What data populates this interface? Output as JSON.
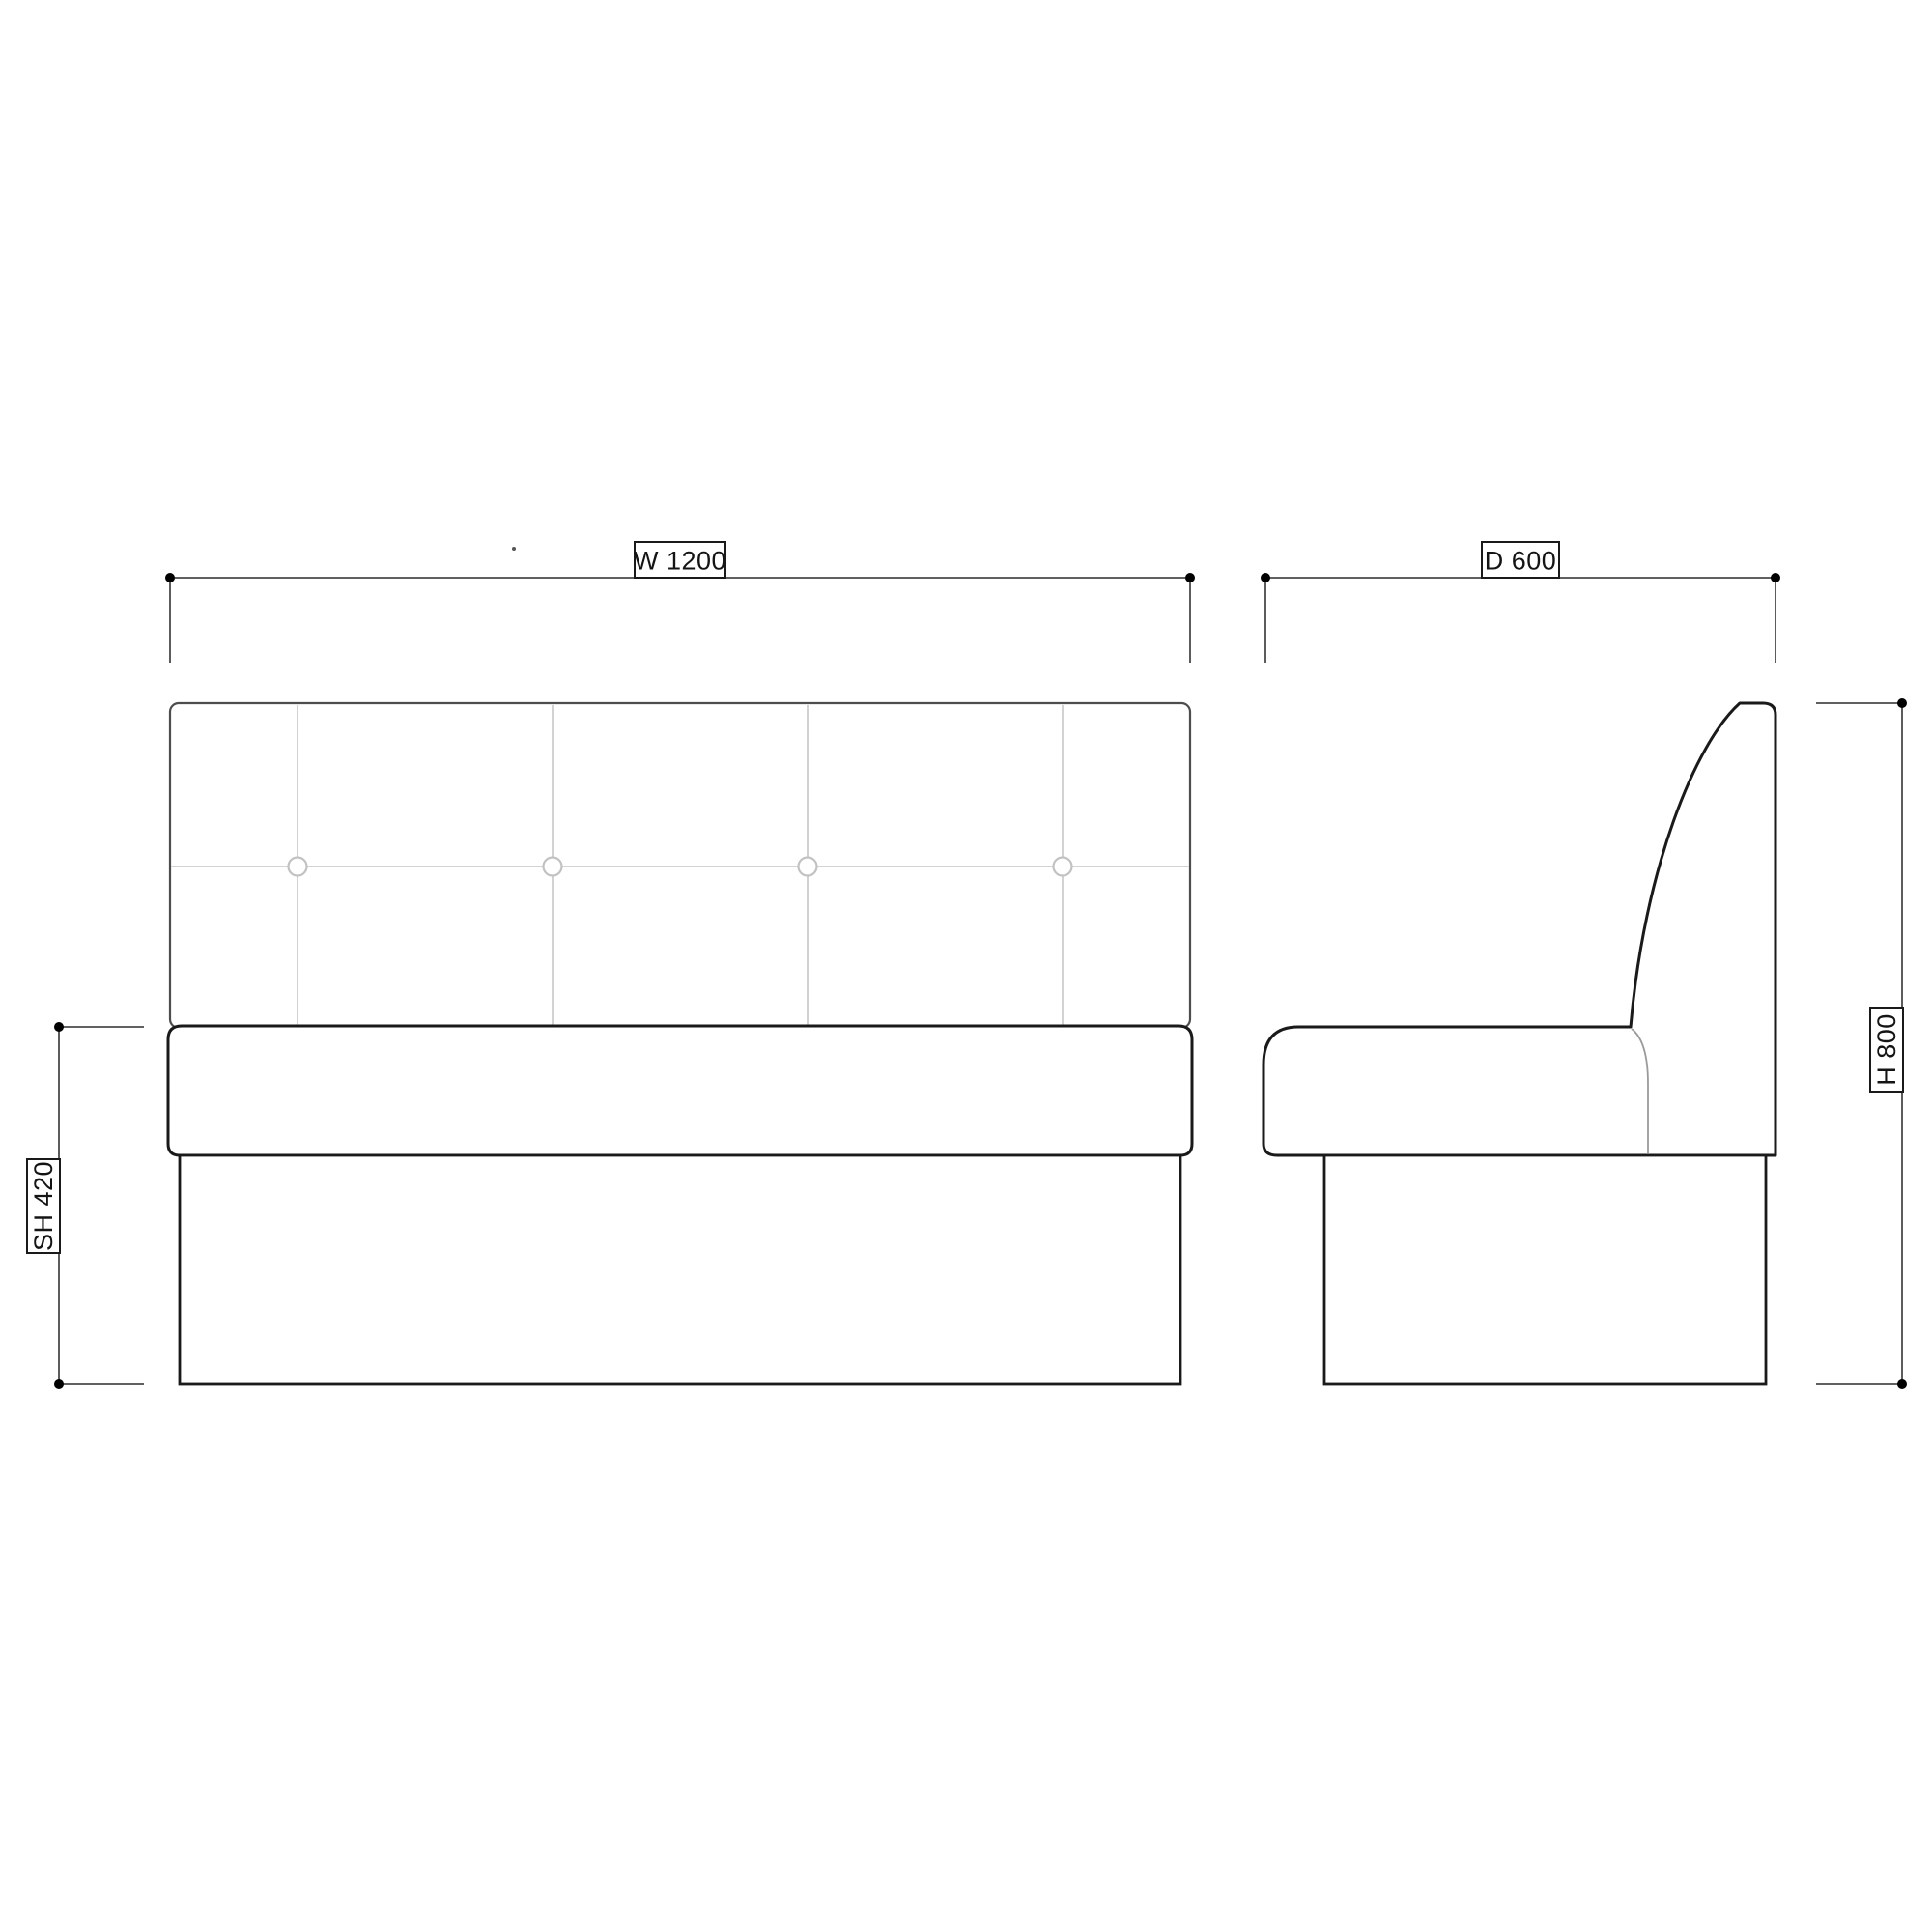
{
  "dimensions": {
    "width": {
      "label": "W 1200",
      "value": 1200,
      "axis": "horizontal"
    },
    "depth": {
      "label": "D 600",
      "value": 600,
      "axis": "horizontal"
    },
    "height": {
      "label": "H 800",
      "value": 800,
      "axis": "vertical"
    },
    "seat_height": {
      "label": "SH 420",
      "value": 420,
      "axis": "vertical"
    }
  },
  "colors": {
    "background": "#ffffff",
    "outline_strong": "#1a1a1a",
    "outline_light": "#4d4d4d",
    "seam": "#cdcdcd",
    "dimension_line": "#4a4a4a",
    "dimension_dot": "#000000",
    "label_text": "#141414"
  }
}
